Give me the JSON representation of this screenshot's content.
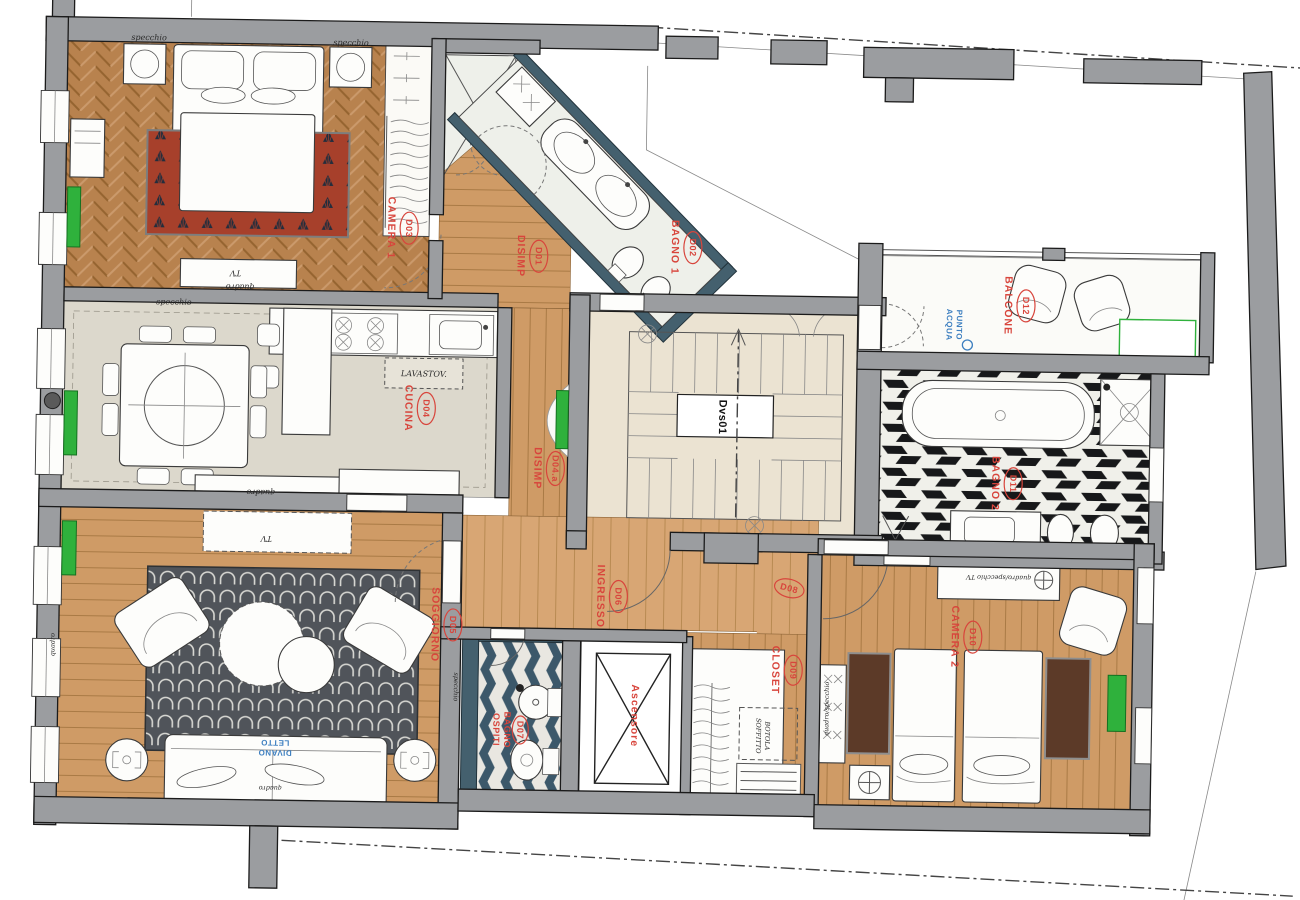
{
  "rooms": {
    "d03": {
      "code": "D03",
      "name": "CAMERA 1"
    },
    "d01": {
      "code": "D01",
      "name": "DISIMP"
    },
    "d02": {
      "code": "D02",
      "name": "BAGNO 1"
    },
    "d12": {
      "code": "D12",
      "name": "BALCONE"
    },
    "d04": {
      "code": "D04",
      "name": "CUCINA"
    },
    "d04a": {
      "code": "D04.a",
      "name": "DISIMP"
    },
    "d11": {
      "code": "D11",
      "name": "BAGNO 2"
    },
    "d05": {
      "code": "D05",
      "name": "SOGGIORNO"
    },
    "d06": {
      "code": "D06",
      "name": "INGRESSO"
    },
    "d07": {
      "code": "D07",
      "name_line1": "BAGNO",
      "name_line2": "OSPITI"
    },
    "d08": {
      "code": "D08"
    },
    "d09": {
      "code": "D09",
      "name": "CLOSET"
    },
    "d10": {
      "code": "D10",
      "name": "CAMERA 2"
    },
    "stairwell": {
      "code": "Dvs01"
    },
    "ascensore": {
      "name": "Ascensore"
    }
  },
  "annotations": {
    "specchio": "specchio",
    "quadro": "quadro",
    "tv": "TV",
    "lavastoviglie": "LAVASTOV.",
    "divano_line1": "DIVANO",
    "divano_line2": "LETTO",
    "punto_acqua_line1": "PUNTO",
    "punto_acqua_line2": "ACQUA",
    "botola_line1": "BOTOLA",
    "botola_line2": "SOFFITTO",
    "quadro_specchio_tv": "quadro/specchio TV",
    "quadro_specchio": "quadro/specchio"
  },
  "colors": {
    "wall_gray": "#9b9da0",
    "bath_wall_slate": "#44606e",
    "room_label_red": "#d8453c",
    "note_blue": "#3d7fc0",
    "radiator_green": "#2fb13c",
    "parquet_brown": "#b8824e",
    "rug_red": "#a7402b",
    "rug_dark": "#50545a",
    "kitchen_floor": "#dcd8cc",
    "marble": "#ebe3d2"
  }
}
